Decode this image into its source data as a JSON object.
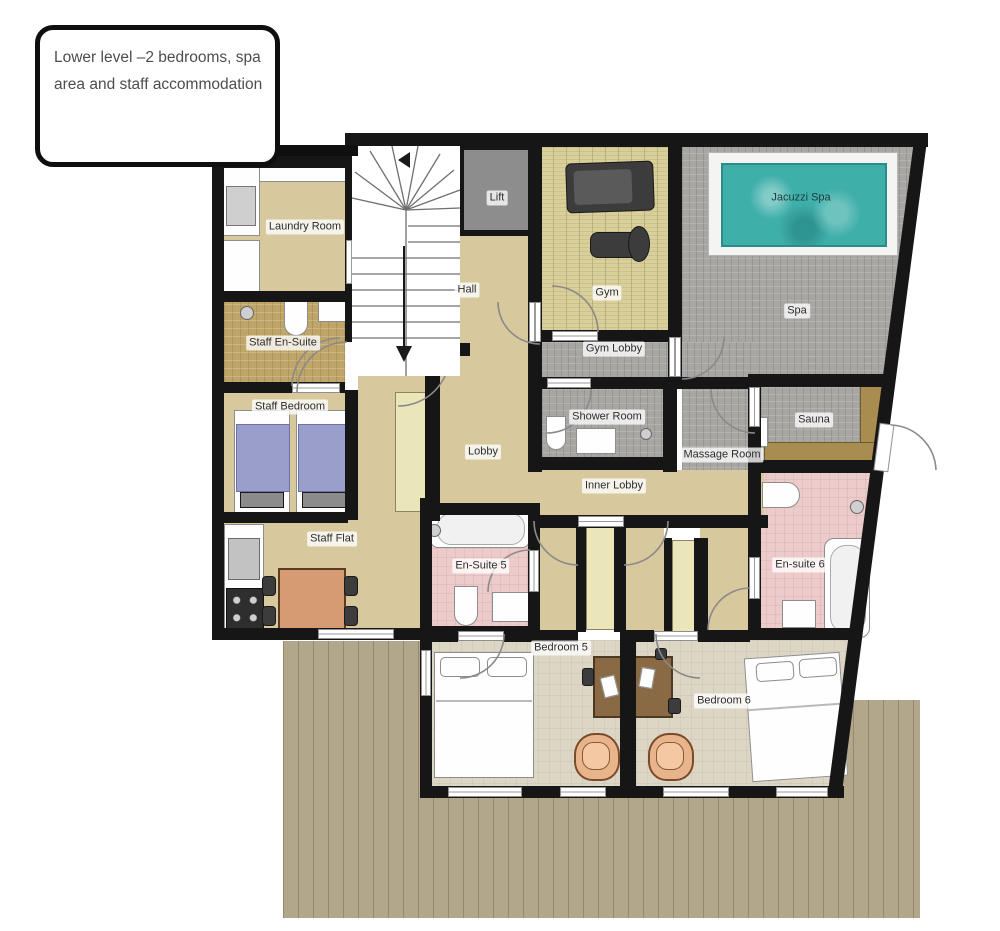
{
  "callout": {
    "text": "Lower level –2 bedrooms, spa area and staff accommodation"
  },
  "rooms": {
    "laundry": {
      "label": "Laundry Room"
    },
    "lift": {
      "label": "Lift"
    },
    "gym": {
      "label": "Gym"
    },
    "jacuzzi": {
      "label": "Jacuzzi Spa"
    },
    "spa": {
      "label": "Spa"
    },
    "hall": {
      "label": "Hall"
    },
    "staff_ensuite": {
      "label": "Staff En-Suite"
    },
    "gym_lobby": {
      "label": "Gym Lobby"
    },
    "staff_bedroom": {
      "label": "Staff Bedroom"
    },
    "shower_room": {
      "label": "Shower Room"
    },
    "sauna": {
      "label": "Sauna"
    },
    "lobby": {
      "label": "Lobby"
    },
    "massage": {
      "label": "Massage Room"
    },
    "inner_lobby": {
      "label": "Inner Lobby"
    },
    "staff_flat": {
      "label": "Staff Flat"
    },
    "ensuite5": {
      "label": "En-Suite 5"
    },
    "ensuite6": {
      "label": "En-suite 6"
    },
    "bedroom5": {
      "label": "Bedroom 5"
    },
    "bedroom6": {
      "label": "Bedroom 6"
    }
  },
  "colors": {
    "wall": "#161616",
    "floor_tan": "#d7c89e",
    "floor_carpet": "#ddd6c5",
    "floor_tile_gray": "#a8a6a2",
    "floor_tile_gold": "#bfa568",
    "floor_tile_pink": "#edcbca",
    "floor_gym": "#d8cf9b",
    "deck": "#b2a68b",
    "jacuzzi_water": "#3fafaa",
    "lift_gray": "#8d8d8d",
    "bed_blue": "#9a9ecb",
    "sauna_bench": "#a98c50",
    "table_wood": "#d79b74"
  }
}
